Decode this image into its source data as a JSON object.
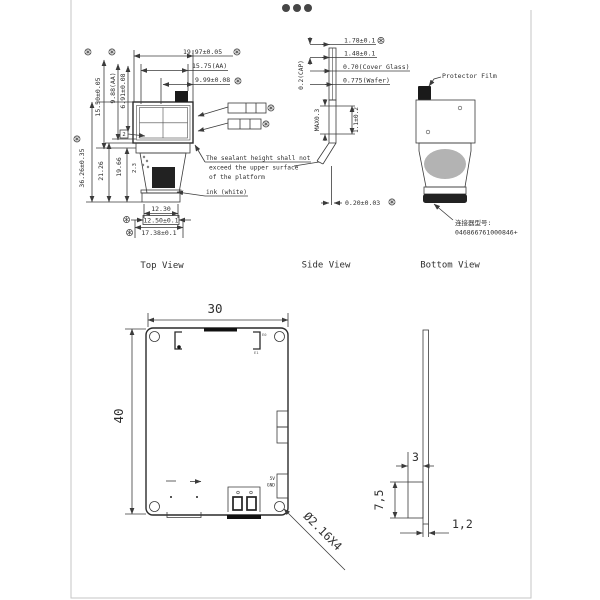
{
  "top_view": {
    "label": "Top View",
    "dim_width_total": "19.97±0.05",
    "dim_width_aa": "15.75(AA)",
    "dim_width_half": "9.99±0.08",
    "dim_height_glass": "15.50±0.05",
    "dim_height_aa": "9.88(AA)",
    "dim_height_inner": "6.91±0.08",
    "dim_total_height": "36.26±0.35",
    "dim_fpc_len1": "21.26",
    "dim_fpc_len2": "19.66",
    "dim_small": "2.3",
    "balloon": "2",
    "dim_conn_inner": "12.30",
    "dim_conn_mid": "12.50±0.1",
    "dim_conn_outer": "17.38±0.1",
    "note_line1": "The sealant height shall not",
    "note_line2": "exceed the upper surface",
    "note_line3": "of the platform",
    "ink_label": "ink (white)"
  },
  "side_view": {
    "label": "Side View",
    "dim_total": "1.78±0.1",
    "dim_sub": "1.48±0.1",
    "dim_cover": "0.70(Cover Glass)",
    "dim_wafer": "0.775(Wafer)",
    "dim_cap": "0.2(CAP)",
    "dim_max": "MAX0.3",
    "dim_body": "1.1±0.2",
    "dim_fpc": "0.20±0.03"
  },
  "bottom_view": {
    "label": "Bottom View",
    "protector": "Protector Film",
    "connector_cn": "连接器型号:",
    "connector_pn": "046866761000846+"
  },
  "pcb": {
    "width": "30",
    "height": "40",
    "hole": "Ø2.16X4",
    "pin_5v": "5V",
    "pin_gnd": "GND",
    "tag_e0": "E0",
    "tag_e1": "E1",
    "side_depth": "3",
    "side_height": "7,5",
    "side_thickness": "1,2"
  },
  "colors": {
    "tape_yellow": "#f3efbd",
    "blob_gray": "#b3b3b3",
    "line": "#3b3b3b"
  }
}
